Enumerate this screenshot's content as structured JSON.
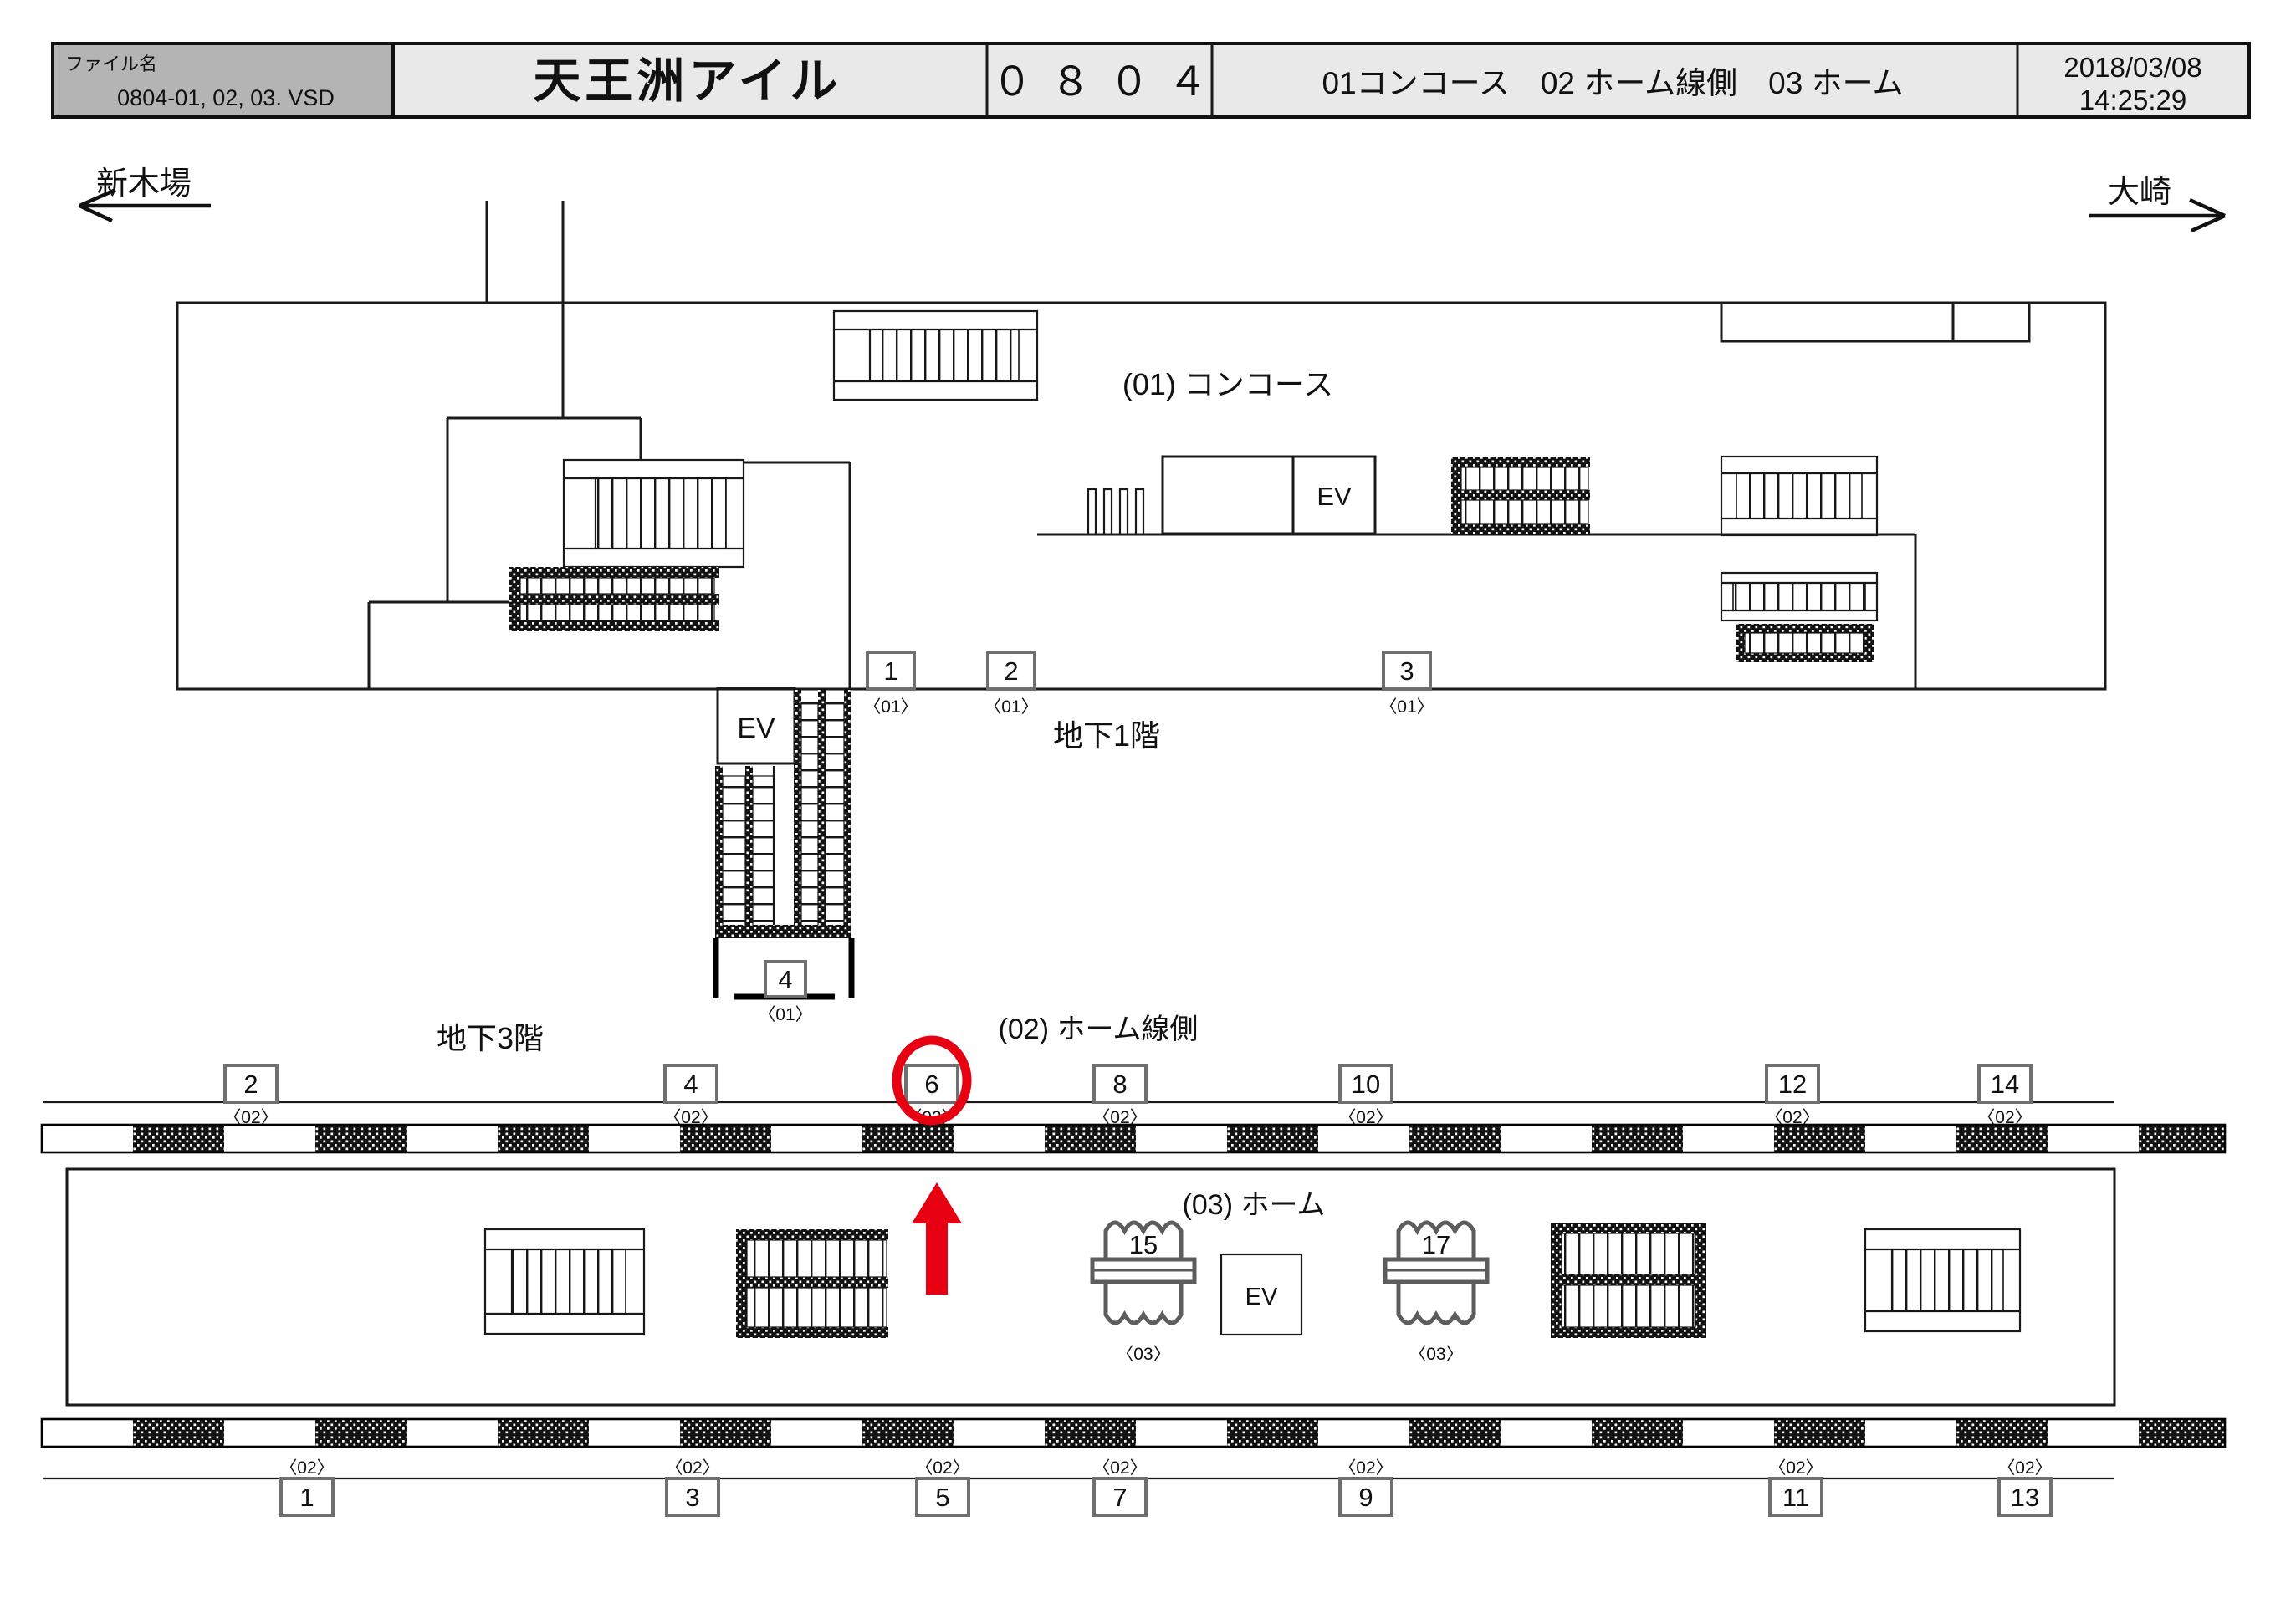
{
  "header": {
    "file_label": "ファイル名",
    "file_name": "0804-01, 02, 03. VSD",
    "station_name": "天王洲アイル",
    "station_code": "０８０４",
    "legend": "01コンコース　02 ホーム線側　03 ホーム",
    "date": "2018/03/08",
    "time": "14:25:29"
  },
  "directions": {
    "left": "新木場",
    "right": "大崎"
  },
  "areas": {
    "concourse": "(01) コンコース",
    "b1": "地下1階",
    "b3": "地下3階",
    "lineside": "(02) ホーム線側",
    "platform": "(03) ホーム"
  },
  "ev_label": "EV",
  "markers": {
    "b1": [
      {
        "no": "1",
        "area": "〈01〉"
      },
      {
        "no": "2",
        "area": "〈01〉"
      },
      {
        "no": "3",
        "area": "〈01〉"
      },
      {
        "no": "4",
        "area": "〈01〉"
      }
    ],
    "lineside_top": [
      {
        "no": "2",
        "area": "〈02〉"
      },
      {
        "no": "4",
        "area": "〈02〉"
      },
      {
        "no": "6",
        "area": "〈02〉"
      },
      {
        "no": "8",
        "area": "〈02〉"
      },
      {
        "no": "10",
        "area": "〈02〉"
      },
      {
        "no": "12",
        "area": "〈02〉"
      },
      {
        "no": "14",
        "area": "〈02〉"
      }
    ],
    "lineside_bottom": [
      {
        "no": "1",
        "area": "〈02〉"
      },
      {
        "no": "3",
        "area": "〈02〉"
      },
      {
        "no": "5",
        "area": "〈02〉"
      },
      {
        "no": "7",
        "area": "〈02〉"
      },
      {
        "no": "9",
        "area": "〈02〉"
      },
      {
        "no": "11",
        "area": "〈02〉"
      },
      {
        "no": "13",
        "area": "〈02〉"
      }
    ],
    "platform": [
      {
        "no": "15",
        "area": "〈03〉"
      },
      {
        "no": "17",
        "area": "〈03〉"
      }
    ]
  },
  "annotation": {
    "highlighted_marker": "6",
    "highlight_color": "#e60012",
    "arrow_direction": "up"
  },
  "colors": {
    "file_cell_bg": "#b4b4b4",
    "header_bg": "#e9e9e9",
    "line": "#1a1a1a",
    "highlight_red": "#e60012"
  }
}
